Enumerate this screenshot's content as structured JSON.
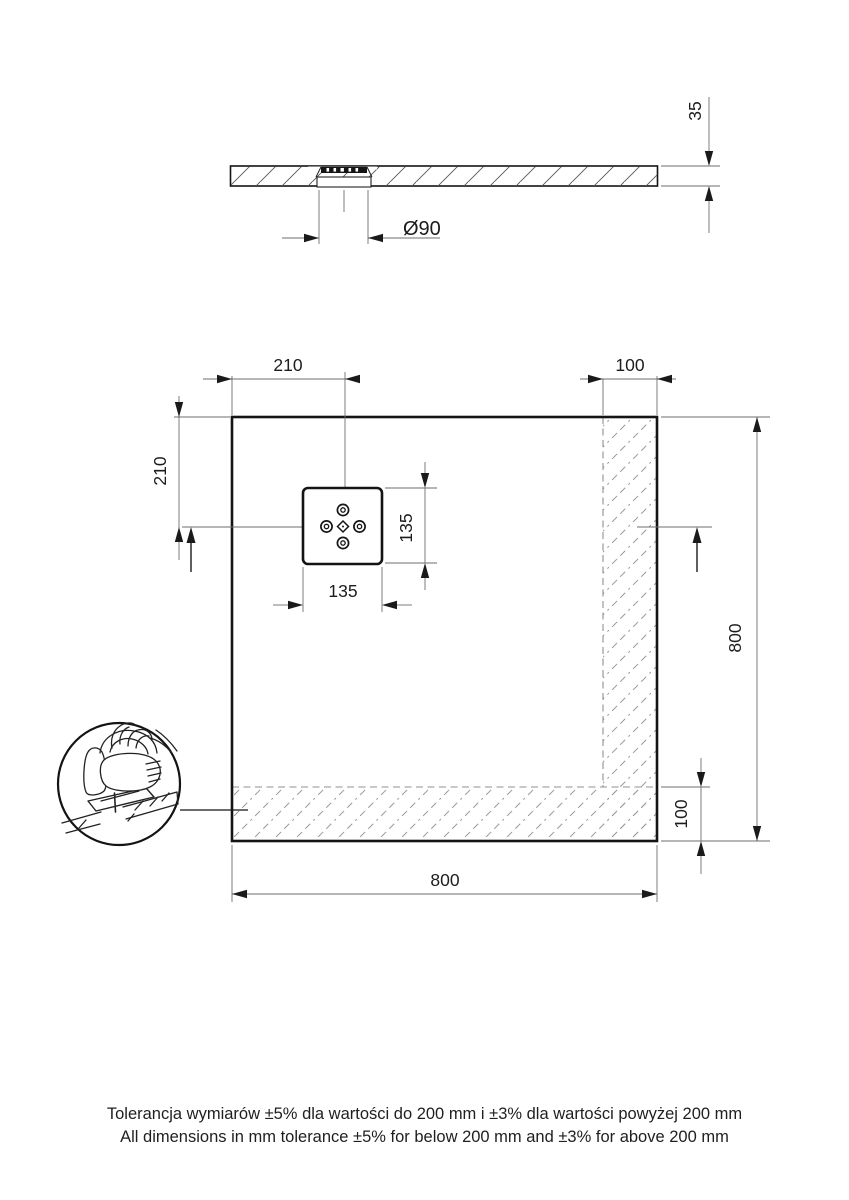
{
  "drawing": {
    "side_view": {
      "thickness_dim": "35",
      "drain_diameter_dim": "Ø90"
    },
    "plan_view": {
      "drain_offset_x_dim": "210",
      "edge_band_top_dim": "100",
      "drain_offset_y_dim": "210",
      "overall_height_dim": "800",
      "drain_width_dim": "135",
      "drain_height_dim": "135",
      "edge_band_bottom_dim": "100",
      "overall_width_dim": "800"
    },
    "notes": {
      "tolerance_pl": "Tolerancja wymiarów ±5% dla wartości do 200 mm i ±3% dla wartości powyżej 200 mm",
      "tolerance_en": "All dimensions in mm tolerance ±5% for below 200 mm and ±3% for above 200 mm"
    },
    "icons": {
      "jigsaw_detail": "jigsaw-cutting-icon",
      "drain_ornament": "drain-ornament-icon"
    },
    "colors": {
      "outline": "#141414",
      "dimension_lines": "#6e6e6e",
      "hatch": "#999999",
      "background": "#ffffff"
    }
  }
}
